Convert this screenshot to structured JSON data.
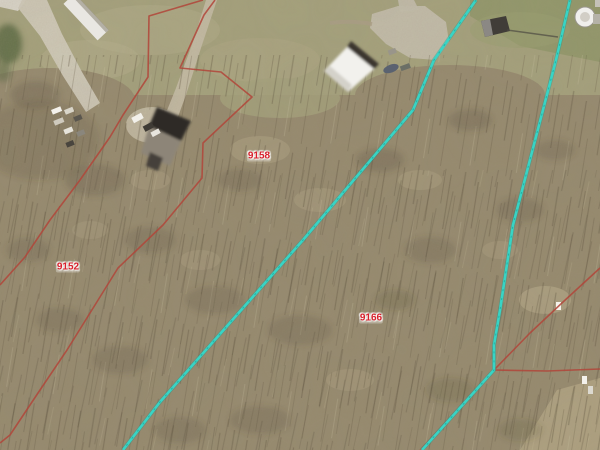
{
  "map": {
    "type": "aerial-parcel-view",
    "colors": {
      "parcel_line": "#b2453a",
      "parcel_label_text": "#d81f2b",
      "highlight_line": "#38d4c5",
      "highlight_line_core": "#13948a"
    },
    "parcel_labels": [
      {
        "id": "9152",
        "x": 68,
        "y": 267
      },
      {
        "id": "9158",
        "x": 259,
        "y": 156
      },
      {
        "id": "9166",
        "x": 371,
        "y": 318
      }
    ],
    "parcel_lines_red": [
      {
        "name": "red-boundary-west",
        "points": "203,0 149,16 148,77 123,115 110,137 80,180 50,220 25,257 0,285"
      },
      {
        "name": "red-boundary-flag-strip",
        "points": "215,0 204,15 180,68 221,72 252,97 203,143 202,178 163,225 118,268 67,350 38,393 10,435 0,443"
      },
      {
        "name": "red-boundary-east-diagonal",
        "points": "600,268 563,302 530,333 494,370"
      },
      {
        "name": "red-boundary-east-horizontal",
        "points": "494,370 547,371 600,369"
      },
      {
        "name": "red-boundary-south",
        "points": "494,370 455,412 420,450",
        "faint": true
      }
    ],
    "survey_lines_cyan": [
      {
        "name": "cyan-survey-line-west",
        "points": "476,0 434,60 413,110 303,240 160,402 123,450"
      },
      {
        "name": "cyan-survey-line-east",
        "points": "570,0 556,60 513,225 500,310 494,345 494,370 422,450"
      }
    ],
    "features": [
      "house",
      "barn",
      "shed",
      "trailer",
      "grain-bin",
      "vehicles",
      "driveway",
      "road",
      "woods",
      "grass-field"
    ]
  }
}
